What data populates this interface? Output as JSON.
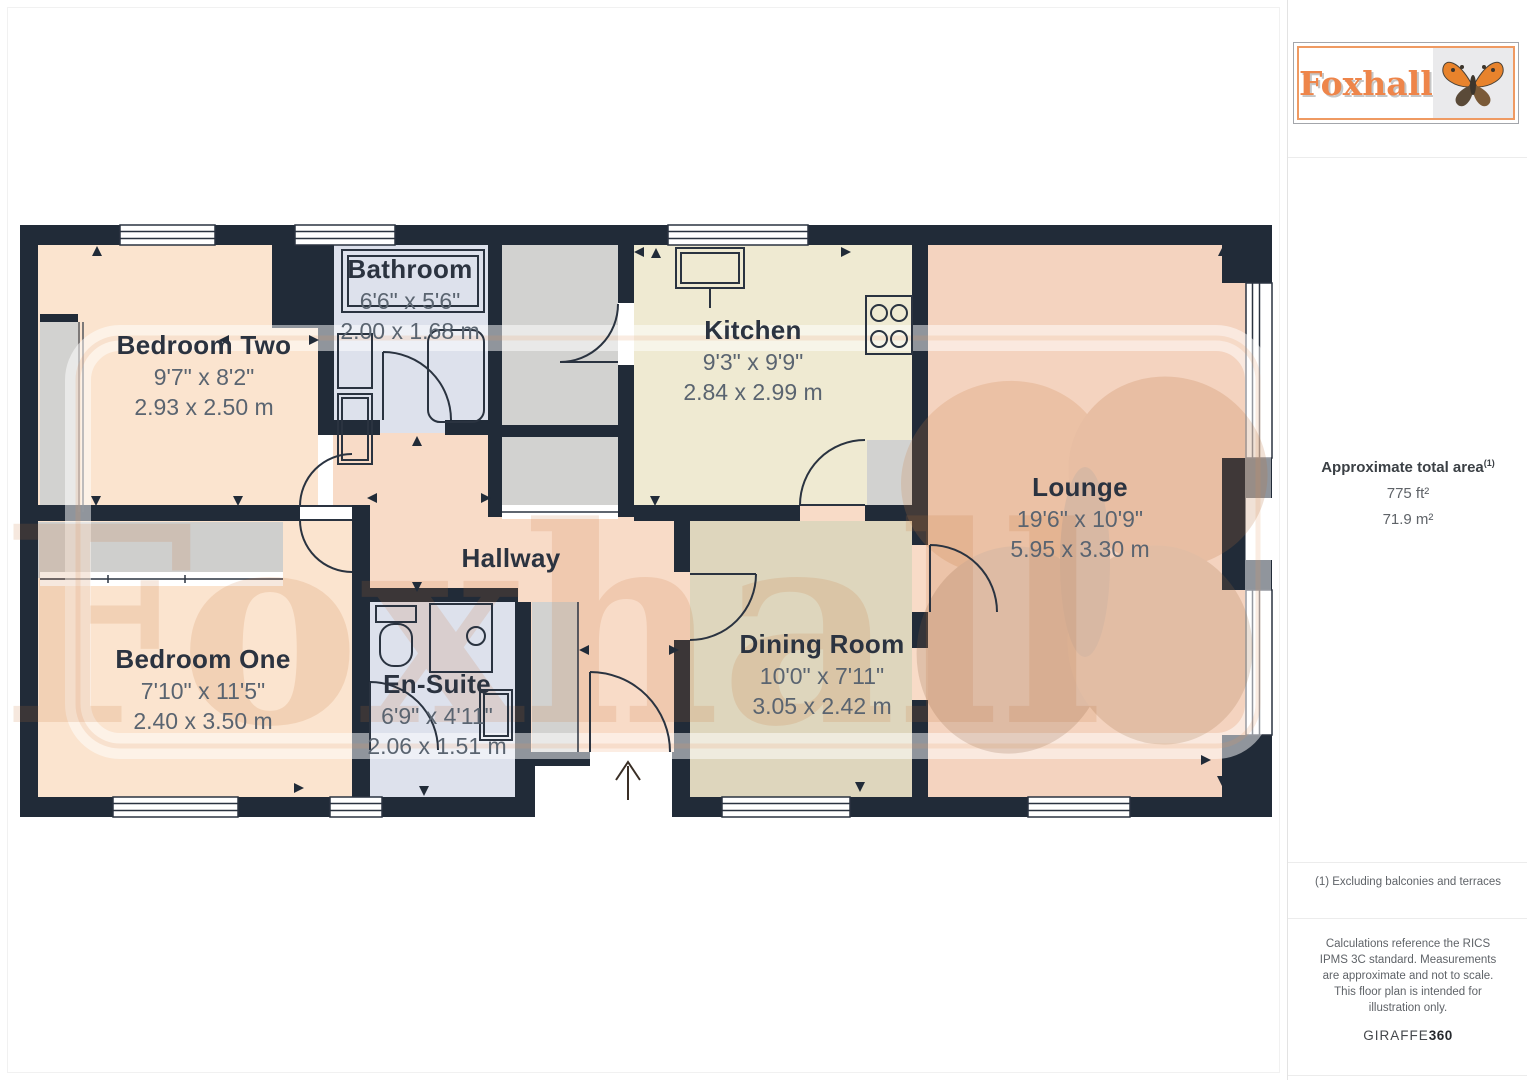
{
  "branding": {
    "logo_text": "Foxhall",
    "watermark_text": "Foxhall"
  },
  "sidebar": {
    "area": {
      "title": "Approximate total area",
      "superscript": "(1)",
      "imperial": "775 ft²",
      "metric": "71.9 m²"
    },
    "footnote": "(1) Excluding balconies and terraces",
    "disclaimer": "Calculations reference the RICS IPMS 3C standard. Measurements are approximate and not to scale. This floor plan is intended for illustration only.",
    "provider": {
      "name": "GIRAFFE",
      "suffix": "360"
    }
  },
  "rooms": [
    {
      "id": "bedroom-two",
      "name": "Bedroom Two",
      "imperial": "9'7\" x 8'2\"",
      "metric": "2.93 x 2.50 m"
    },
    {
      "id": "bathroom",
      "name": "Bathroom",
      "imperial": "6'6\" x 5'6\"",
      "metric": "2.00 x 1.68 m"
    },
    {
      "id": "kitchen",
      "name": "Kitchen",
      "imperial": "9'3\" x 9'9\"",
      "metric": "2.84 x 2.99 m"
    },
    {
      "id": "lounge",
      "name": "Lounge",
      "imperial": "19'6\" x 10'9\"",
      "metric": "5.95 x 3.30 m"
    },
    {
      "id": "hallway",
      "name": "Hallway"
    },
    {
      "id": "bedroom-one",
      "name": "Bedroom One",
      "imperial": "7'10\" x 11'5\"",
      "metric": "2.40 x 3.50 m"
    },
    {
      "id": "en-suite",
      "name": "En-Suite",
      "imperial": "6'9\" x 4'11\"",
      "metric": "2.06 x 1.51 m"
    },
    {
      "id": "dining-room",
      "name": "Dining Room",
      "imperial": "10'0\" x 7'11\"",
      "metric": "3.05 x 2.42 m"
    }
  ],
  "colors": {
    "wall": "#212b38",
    "bedroom_floor": "#fbe4cf",
    "hallway_floor": "#f8dbc7",
    "bathroom_floor": "#dde1ec",
    "kitchen_floor": "#efead2",
    "lounge_floor": "#f4d3bf",
    "dining_floor": "#ded6bd",
    "storage_floor": "#d2d2d0",
    "accent_orange": "#ee854a"
  }
}
